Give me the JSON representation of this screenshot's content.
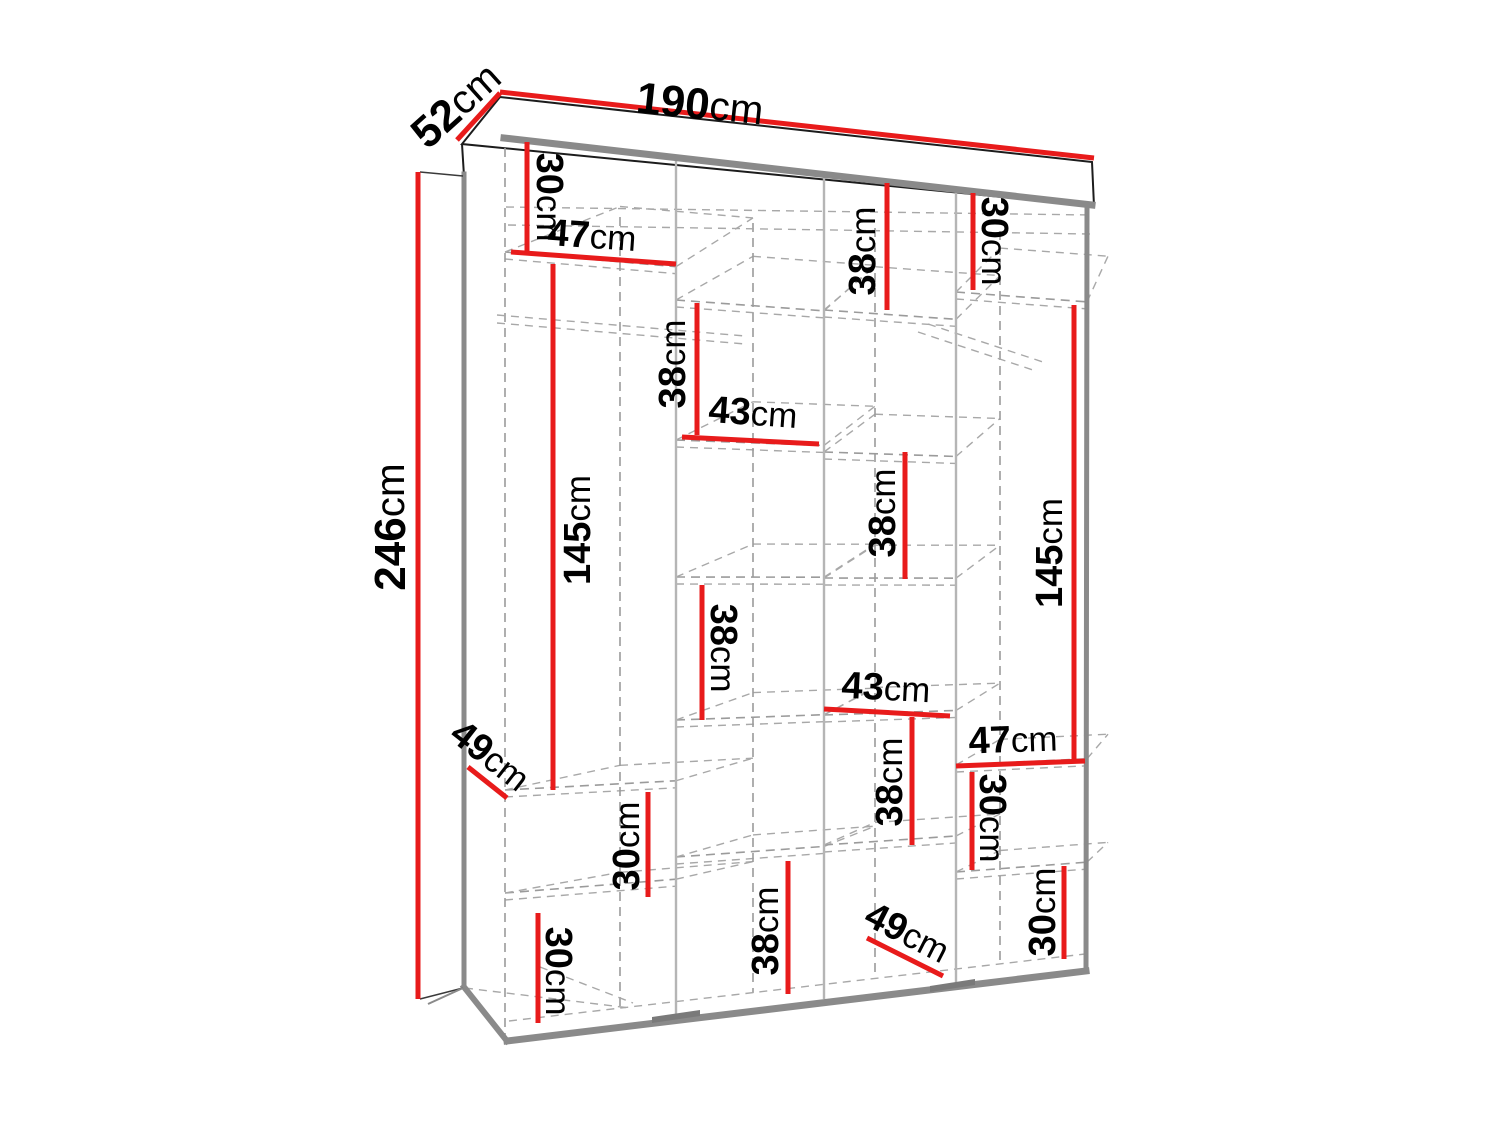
{
  "diagram": {
    "type": "furniture-dimension-diagram",
    "subject": "wardrobe-with-internal-shelves",
    "unit": "cm",
    "colors": {
      "dimension_red": "#e81b1b",
      "outline_gray": "#8a8a8a",
      "dashed_gray": "#9b9b9b",
      "text_black": "#000000",
      "background": "#ffffff"
    },
    "overall": {
      "width_cm": 190,
      "depth_cm": 52,
      "height_cm": 246
    },
    "dimensions": [
      {
        "id": "depth-total",
        "value": "52",
        "unit": "cm",
        "kind": "overall",
        "line": [
          457,
          140,
          500,
          93
        ],
        "label": [
          456,
          105
        ],
        "rot": -42
      },
      {
        "id": "width-total",
        "value": "190",
        "unit": "cm",
        "kind": "overall",
        "line": [
          500,
          92,
          1094,
          158
        ],
        "label": [
          700,
          104
        ],
        "rot": 6
      },
      {
        "id": "height-total",
        "value": "246",
        "unit": "cm",
        "kind": "overall",
        "line": [
          418,
          172,
          418,
          999
        ],
        "label": [
          390,
          527
        ],
        "rot": -90
      },
      {
        "id": "top-left-cell-height",
        "value": "30",
        "unit": "cm",
        "kind": "part",
        "line": [
          527,
          142,
          527,
          252
        ],
        "label": [
          549,
          197
        ],
        "rot": 90
      },
      {
        "id": "left-shelf-width",
        "value": "47",
        "unit": "cm",
        "kind": "part",
        "line": [
          511,
          252,
          676,
          264
        ],
        "label": [
          592,
          236
        ],
        "rot": 4
      },
      {
        "id": "top-mid-cell-height",
        "value": "38",
        "unit": "cm",
        "kind": "part",
        "line": [
          887,
          183,
          887,
          310
        ],
        "label": [
          863,
          251
        ],
        "rot": -90
      },
      {
        "id": "top-right-cell-height",
        "value": "30",
        "unit": "cm",
        "kind": "part",
        "line": [
          973,
          193,
          973,
          290
        ],
        "label": [
          994,
          241
        ],
        "rot": 90
      },
      {
        "id": "left-hanging-height",
        "value": "145",
        "unit": "cm",
        "kind": "part",
        "line": [
          553,
          264,
          553,
          790
        ],
        "label": [
          578,
          530
        ],
        "rot": -90
      },
      {
        "id": "mid-upper-cell-height",
        "value": "38",
        "unit": "cm",
        "kind": "part",
        "line": [
          697,
          303,
          697,
          435
        ],
        "label": [
          673,
          364
        ],
        "rot": -90
      },
      {
        "id": "mid-shelf-width-upper",
        "value": "43",
        "unit": "cm",
        "kind": "part",
        "line": [
          682,
          437,
          819,
          444
        ],
        "label": [
          753,
          413
        ],
        "rot": 4
      },
      {
        "id": "third-col-cell-height",
        "value": "38",
        "unit": "cm",
        "kind": "part",
        "line": [
          905,
          452,
          905,
          579
        ],
        "label": [
          883,
          513
        ],
        "rot": -90
      },
      {
        "id": "right-hanging-height",
        "value": "145",
        "unit": "cm",
        "kind": "part",
        "line": [
          1074,
          305,
          1074,
          762
        ],
        "label": [
          1050,
          553
        ],
        "rot": -90
      },
      {
        "id": "mid-lower-cell-height",
        "value": "38",
        "unit": "cm",
        "kind": "part",
        "line": [
          702,
          585,
          702,
          720
        ],
        "label": [
          723,
          648
        ],
        "rot": 90
      },
      {
        "id": "mid-shelf-width-lower",
        "value": "43",
        "unit": "cm",
        "kind": "part",
        "line": [
          824,
          709,
          950,
          716
        ],
        "label": [
          886,
          688
        ],
        "rot": 3
      },
      {
        "id": "third-col-lower-cell-height",
        "value": "38",
        "unit": "cm",
        "kind": "part",
        "line": [
          912,
          717,
          912,
          845
        ],
        "label": [
          890,
          782
        ],
        "rot": -90
      },
      {
        "id": "right-shelf-width",
        "value": "47",
        "unit": "cm",
        "kind": "part",
        "line": [
          956,
          766,
          1085,
          761
        ],
        "label": [
          1013,
          740
        ],
        "rot": -2
      },
      {
        "id": "right-cell-height-upper",
        "value": "30",
        "unit": "cm",
        "kind": "part",
        "line": [
          972,
          772,
          972,
          870
        ],
        "label": [
          992,
          818
        ],
        "rot": 90
      },
      {
        "id": "bottom-left-shelf-depth",
        "value": "49",
        "unit": "cm",
        "kind": "part",
        "line": [
          468,
          767,
          507,
          798
        ],
        "label": [
          490,
          756
        ],
        "rot": 38
      },
      {
        "id": "left-col-cell-height-upper",
        "value": "30",
        "unit": "cm",
        "kind": "part",
        "line": [
          648,
          792,
          648,
          897
        ],
        "label": [
          627,
          846
        ],
        "rot": -90
      },
      {
        "id": "left-col-cell-height-lower",
        "value": "30",
        "unit": "cm",
        "kind": "part",
        "line": [
          538,
          913,
          538,
          1023
        ],
        "label": [
          558,
          971
        ],
        "rot": 90
      },
      {
        "id": "mid-bottom-cell-height",
        "value": "38",
        "unit": "cm",
        "kind": "part",
        "line": [
          788,
          861,
          788,
          994
        ],
        "label": [
          766,
          931
        ],
        "rot": -90
      },
      {
        "id": "bottom-mid-shelf-depth",
        "value": "49",
        "unit": "cm",
        "kind": "part",
        "line": [
          867,
          938,
          943,
          976
        ],
        "label": [
          907,
          933
        ],
        "rot": 27
      },
      {
        "id": "right-bottom-cell-height",
        "value": "30",
        "unit": "cm",
        "kind": "part",
        "line": [
          1064,
          866,
          1064,
          959
        ],
        "label": [
          1043,
          912
        ],
        "rot": -90
      }
    ]
  }
}
